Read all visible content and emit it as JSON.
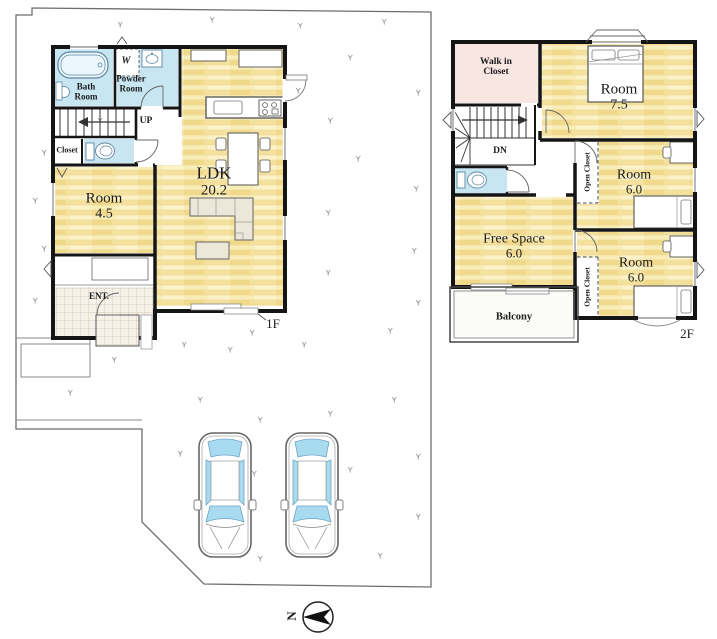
{
  "floor1": {
    "label": "1F",
    "rooms": {
      "bath": "Bath Room",
      "washer": "W",
      "powder": "Powder Room",
      "stairs_up": "UP",
      "closet": "Closet",
      "room": {
        "name": "Room",
        "size": "4.5"
      },
      "ldk": {
        "name": "LDK",
        "size": "20.2"
      },
      "entrance": "ENT."
    }
  },
  "floor2": {
    "label": "2F",
    "rooms": {
      "walk_in_closet": "Walk in Closet",
      "stairs_down": "DN",
      "room_75": {
        "name": "Room",
        "size": "7.5"
      },
      "room_6a": {
        "name": "Room",
        "size": "6.0"
      },
      "room_6b": {
        "name": "Room",
        "size": "6.0"
      },
      "open_closet_a": "Open Closet",
      "open_closet_b": "Open Closet",
      "free_space": {
        "name": "Free Space",
        "size": "6.0"
      },
      "balcony": "Balcony"
    }
  },
  "compass": {
    "north": "N"
  },
  "colors": {
    "wood_floor": "#F6E6A8",
    "wet_area": "#C8E5F2",
    "closet_pink": "#F8E6E3",
    "car_glass": "#A8DBEF",
    "wall": "#151515"
  }
}
